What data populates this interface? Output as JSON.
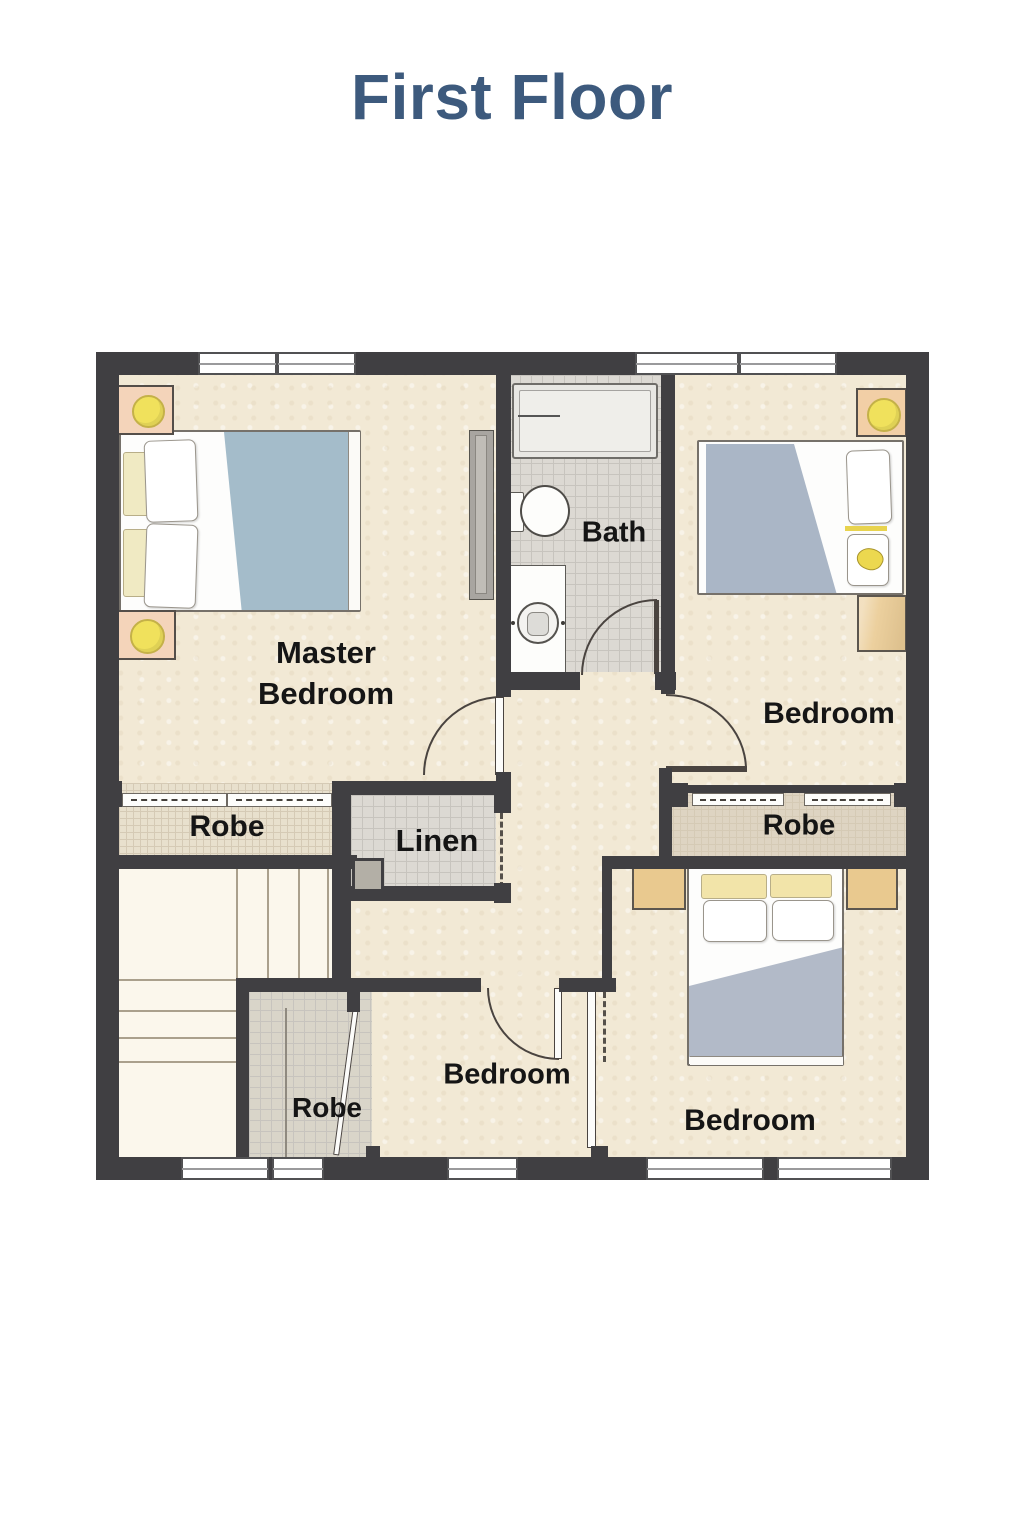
{
  "title": "First Floor",
  "rooms": {
    "master_bedroom": {
      "label": "Master Bedroom"
    },
    "bath": {
      "label": "Bath"
    },
    "bedroom_top_right": {
      "label": "Bedroom"
    },
    "robe_master": {
      "label": "Robe"
    },
    "linen": {
      "label": "Linen"
    },
    "robe_right": {
      "label": "Robe"
    },
    "robe_bottom": {
      "label": "Robe"
    },
    "bedroom_bottom_middle": {
      "label": "Bedroom"
    },
    "bedroom_bottom_right": {
      "label": "Bedroom"
    }
  },
  "colors": {
    "title_color": "#3d5a7d",
    "wall": "#403f42",
    "floor": "#f2e9d5",
    "tile_floor": "#dcd9d3",
    "tile_line": "#c7c4be",
    "robe_floor": "#e8e0cd",
    "robe_line": "#d5cab5",
    "stairs_floor": "#fbf7ec",
    "blanket_blue": "#a4bcca",
    "blanket_gray": "#aab6c6",
    "lamp_yellow": "#f0e15c",
    "wood": "#ecd09e",
    "nightstand_peach": "#f4d4ba",
    "cushion_cream": "#f0eac3",
    "arc_line": "#4a4440"
  }
}
